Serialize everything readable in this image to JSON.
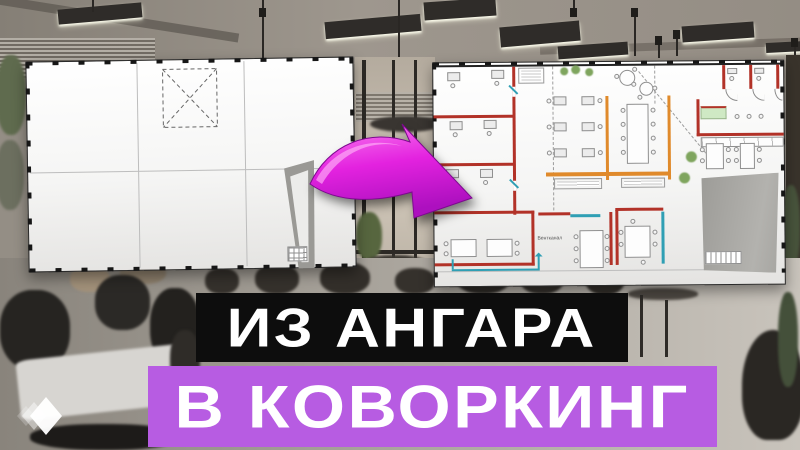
{
  "title": {
    "line1": "ИЗ АНГАРА",
    "line2": "В КОВОРКИНГ"
  },
  "plan_labels": {
    "vent_shaft": "Вентканал"
  },
  "icons": {
    "logo": "triple-diamond-icon",
    "arrow": "transform-arrow-icon"
  },
  "colors": {
    "pink": "#b75ce2",
    "black": "#0d0d0d",
    "magenta": "#e32ae0",
    "red": "#b23228",
    "orange": "#e08a2b",
    "teal": "#2f9fb4",
    "green": "#cfe9c4",
    "white": "#ffffff"
  }
}
